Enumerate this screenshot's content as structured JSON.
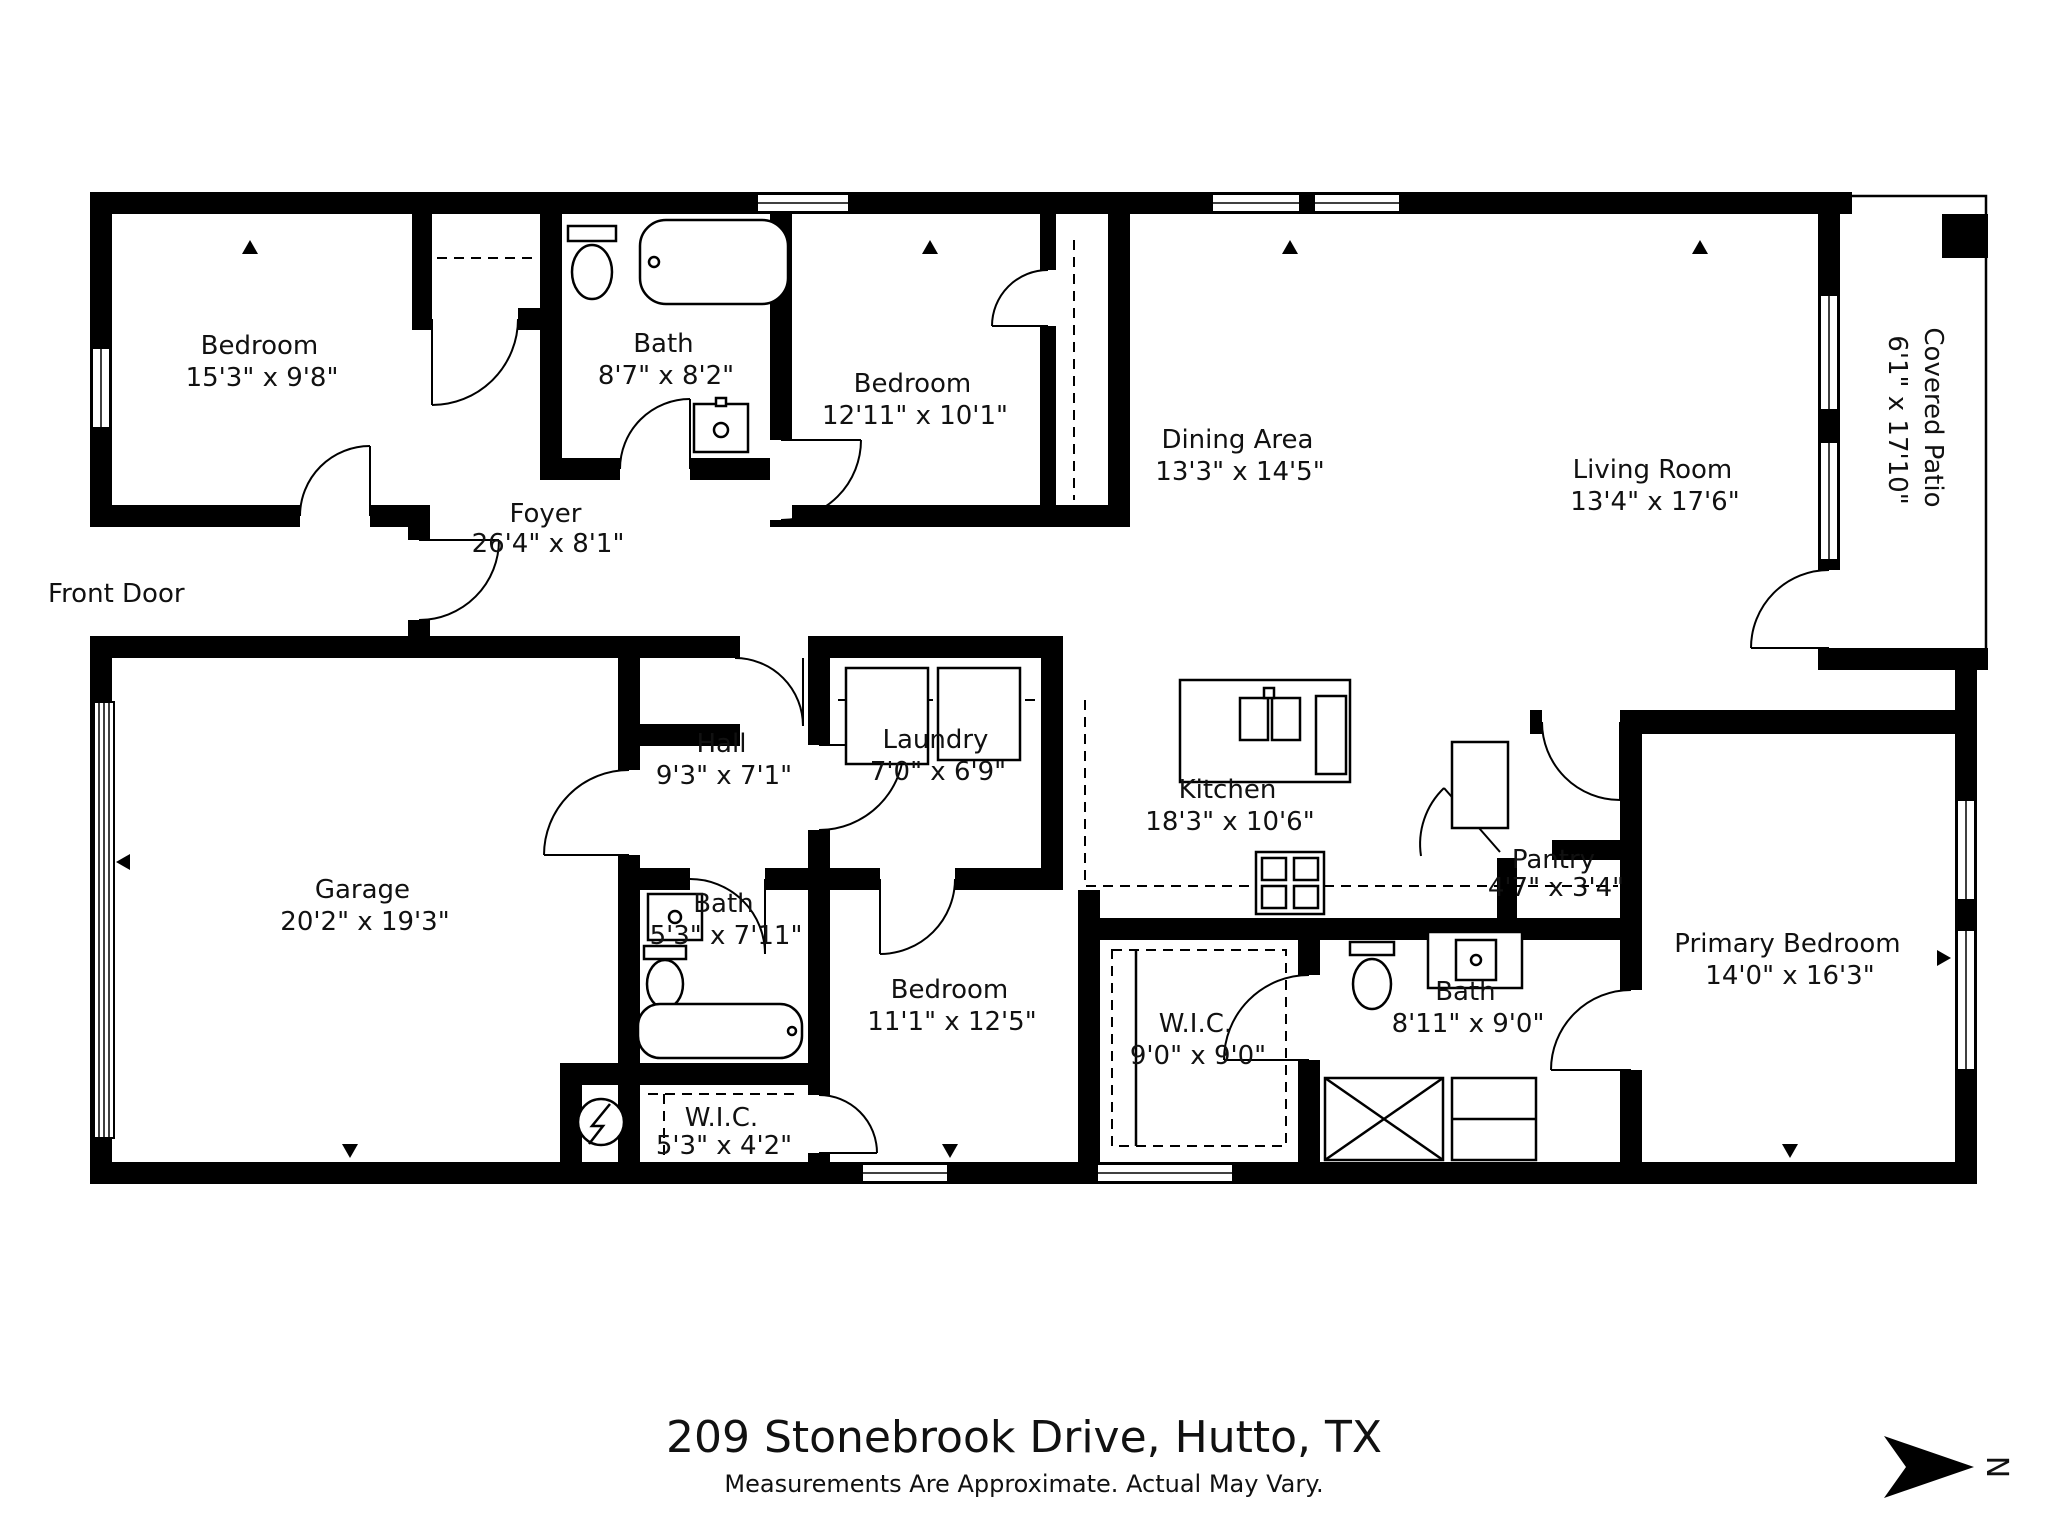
{
  "title": {
    "address": "209 Stonebrook Drive, Hutto, TX",
    "disclaimer": "Measurements Are Approximate. Actual May Vary."
  },
  "annotations": {
    "front_door": "Front Door"
  },
  "compass": {
    "label": "N"
  },
  "colors": {
    "wall": "#000000",
    "background": "#ffffff"
  },
  "rooms": [
    {
      "name": "Bedroom",
      "dims": "15'3\" x 9'8\""
    },
    {
      "name": "Bath",
      "dims": "8'7\" x 8'2\""
    },
    {
      "name": "Bedroom",
      "dims": "12'11\" x 10'1\""
    },
    {
      "name": "Dining Area",
      "dims": "13'3\" x 14'5\""
    },
    {
      "name": "Living Room",
      "dims": "13'4\" x 17'6\""
    },
    {
      "name": "Covered Patio",
      "dims": "6'1\" x 17'10\""
    },
    {
      "name": "Foyer",
      "dims": "26'4\" x 8'1\""
    },
    {
      "name": "Garage",
      "dims": "20'2\" x 19'3\""
    },
    {
      "name": "Hall",
      "dims": "9'3\" x 7'1\""
    },
    {
      "name": "Laundry",
      "dims": "7'0\" x 6'9\""
    },
    {
      "name": "Kitchen",
      "dims": "18'3\" x 10'6\""
    },
    {
      "name": "Pantry",
      "dims": "4'7\" x 3'4\""
    },
    {
      "name": "Primary Bedroom",
      "dims": "14'0\" x 16'3\""
    },
    {
      "name": "Bath",
      "dims": "8'11\" x 9'0\""
    },
    {
      "name": "W.I.C.",
      "dims": "9'0\" x 9'0\""
    },
    {
      "name": "Bedroom",
      "dims": "11'1\" x 12'5\""
    },
    {
      "name": "Bath",
      "dims": "5'3\" x 7'11\""
    },
    {
      "name": "W.I.C.",
      "dims": "5'3\" x 4'2\""
    }
  ]
}
